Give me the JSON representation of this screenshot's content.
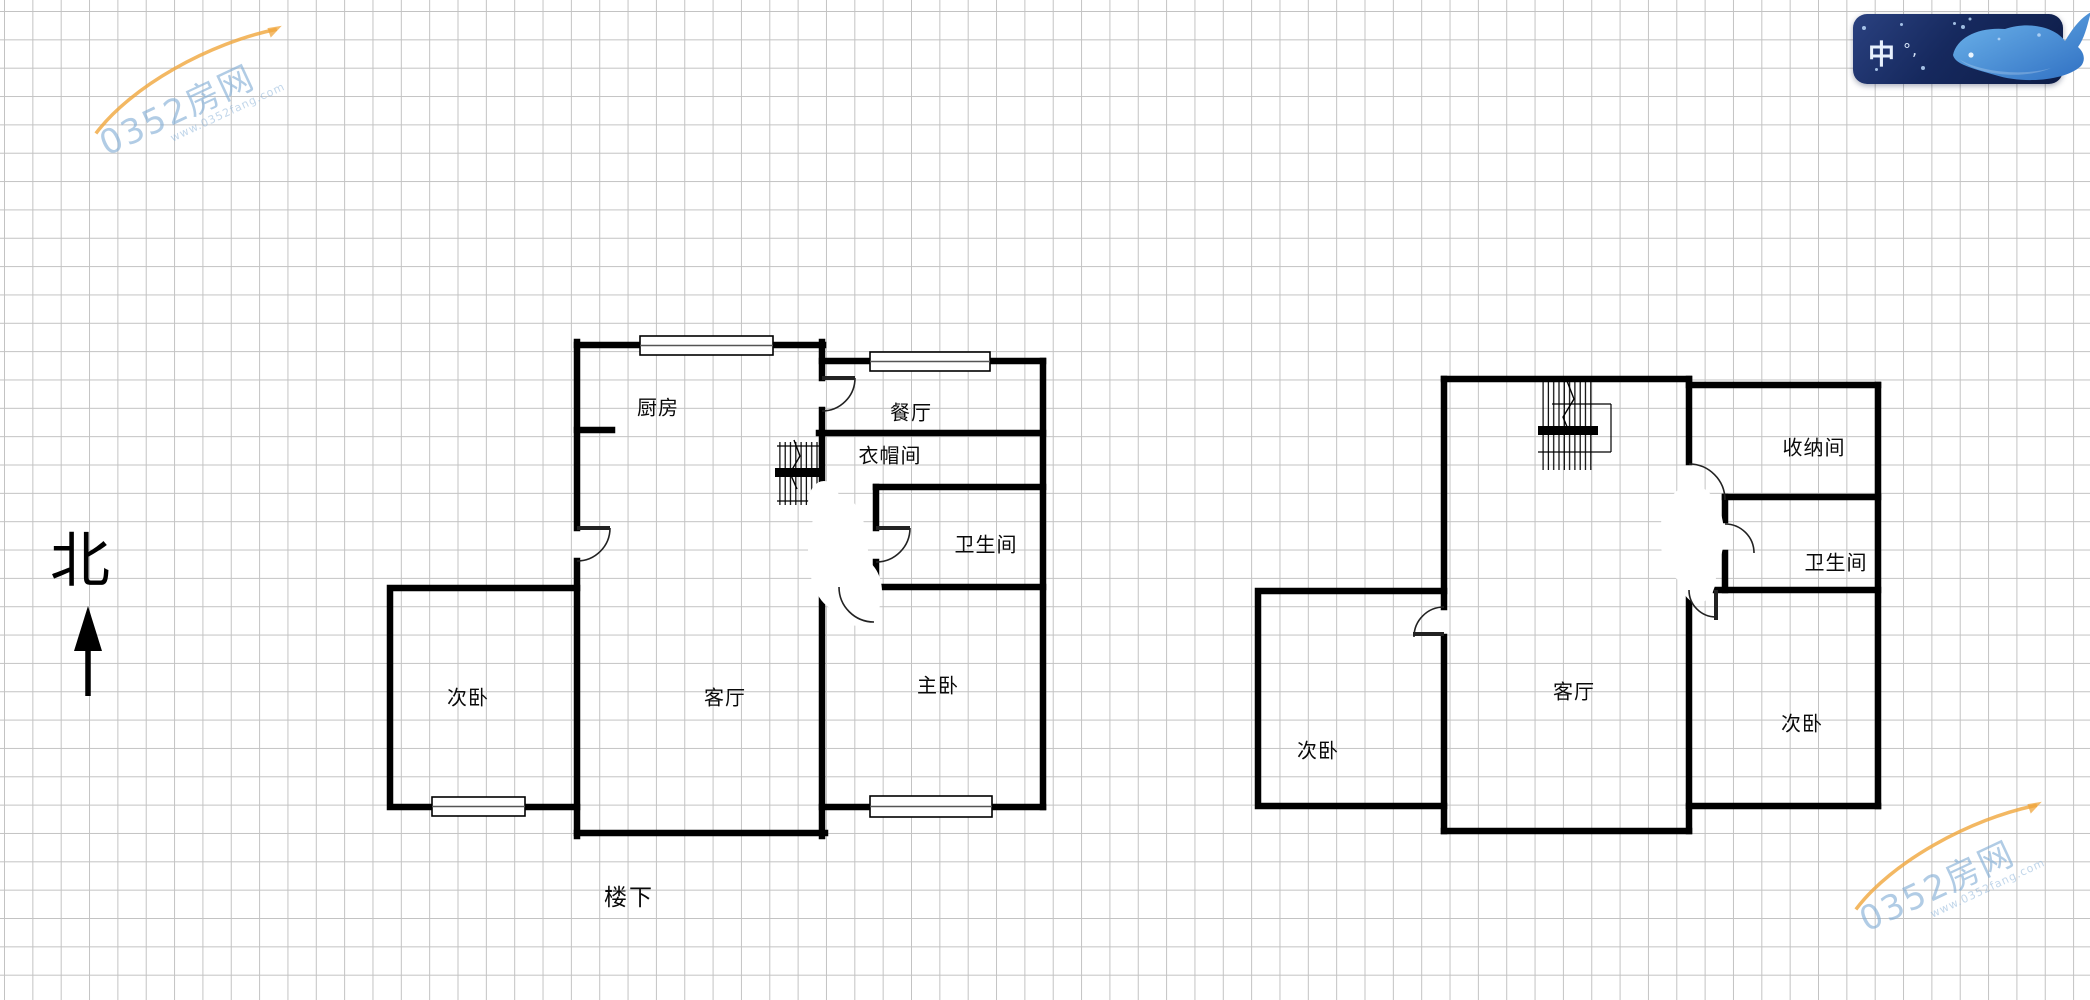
{
  "compass": {
    "north_label": "北"
  },
  "floor_plans": {
    "downstairs": {
      "caption": "楼下",
      "rooms": {
        "kitchen": "厨房",
        "dining_room": "餐厅",
        "cloakroom": "衣帽间",
        "bathroom": "卫生间",
        "master_bedroom": "主卧",
        "living_room": "客厅",
        "secondary_bedroom": "次卧"
      }
    },
    "upstairs": {
      "rooms": {
        "storage_room": "收纳间",
        "bathroom": "卫生间",
        "living_room": "客厅",
        "secondary_bedroom_east": "次卧",
        "secondary_bedroom_west": "次卧"
      }
    }
  },
  "watermark": {
    "brand": "0352房网",
    "url_text": "www.0352fang.com",
    "swoosh_color": "#f0a63c",
    "text_color": "#7daad4"
  },
  "ime_toolbar": {
    "language_mode": "中",
    "punctuation_mode": "°,",
    "bg_color": "#16295e",
    "icon_color": "#d9e8fb"
  }
}
